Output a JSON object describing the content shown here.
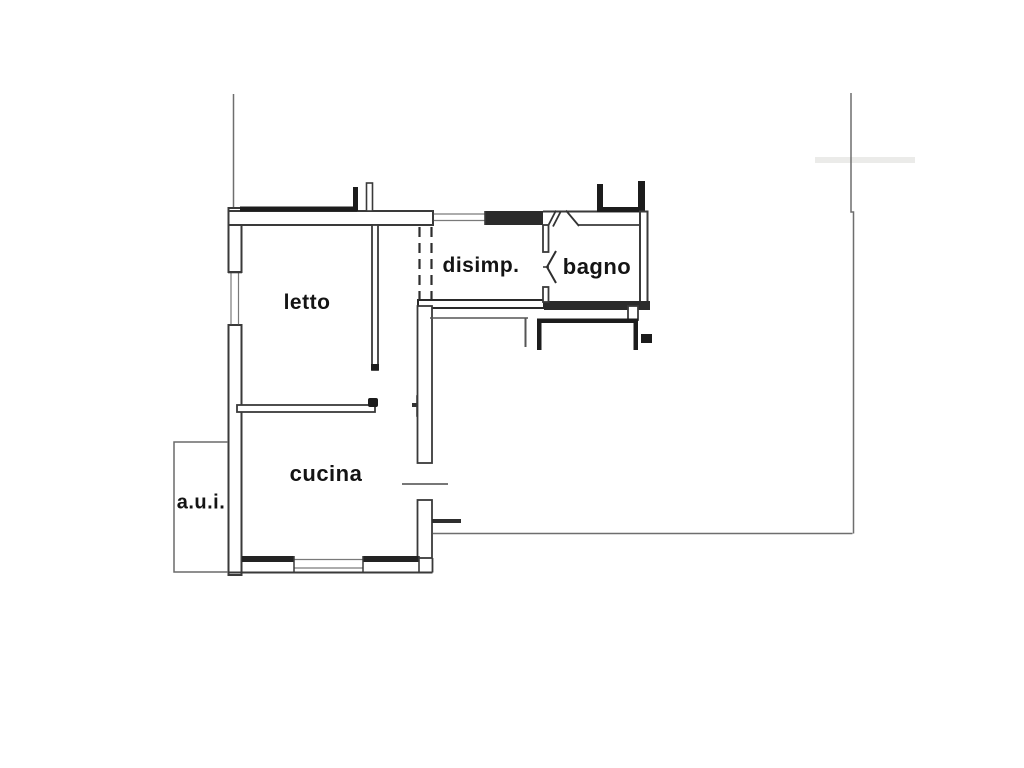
{
  "plan": {
    "background_color": "#ffffff",
    "wall_color": "#3a3a3a",
    "thick_wall_color": "#1c1c1c",
    "boundary_color": "#6e6e6e",
    "label_color": "#141414",
    "rooms": [
      {
        "id": "letto",
        "label": "letto"
      },
      {
        "id": "disimp",
        "label": "disimp."
      },
      {
        "id": "bagno",
        "label": "bagno"
      },
      {
        "id": "cucina",
        "label": "cucina"
      },
      {
        "id": "aui",
        "label": "a.u.i."
      }
    ]
  }
}
